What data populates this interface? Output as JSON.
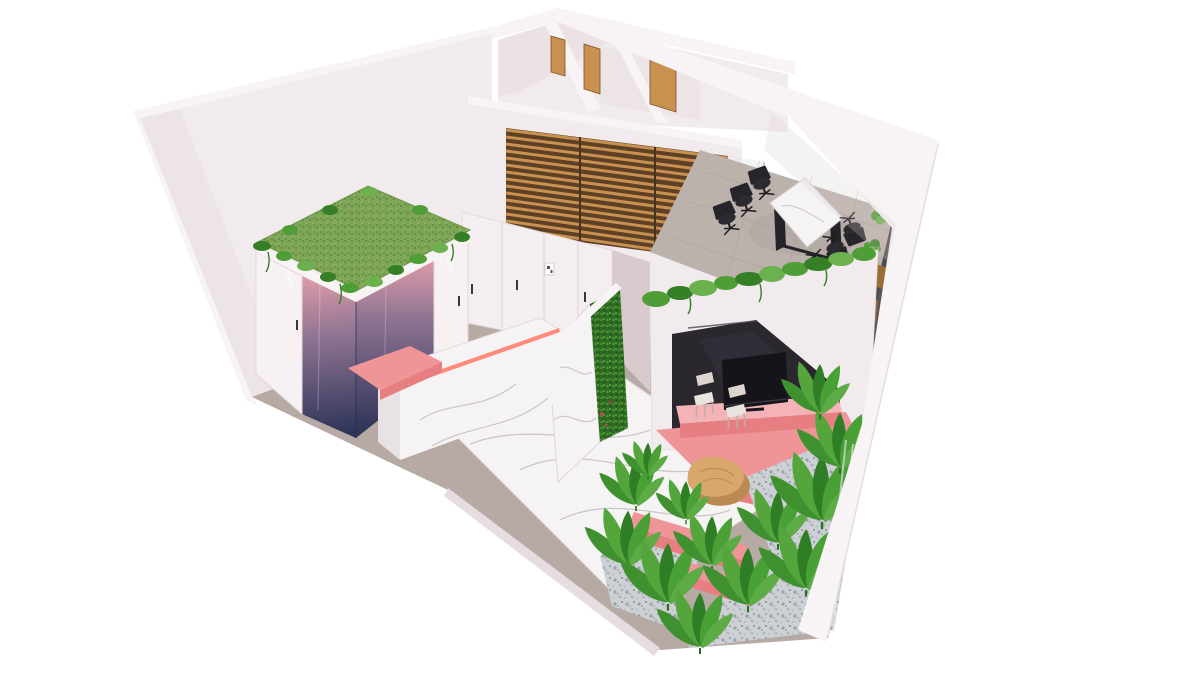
{
  "meta": {
    "title": "Isometric cutaway 3D render of a modern office interior",
    "canvas": {
      "width": 1200,
      "height": 675
    }
  },
  "palette": {
    "bg": "#ffffff",
    "wall": "#f2ebed",
    "wall-edge": "#f8f3f4",
    "wall-shade": "#e7dcdf",
    "wall-dark": "#d8cacd",
    "floor-tile": "#b7aaa4",
    "floor-tile-dark": "#a2968f",
    "marble": "#f6f3f4",
    "marble-vein": "#a9a3ad",
    "grass": "#7fa557",
    "grass-dark": "#5d8a3c",
    "leaf": "#4f9d36",
    "leaf-dark": "#357f26",
    "leaf-light": "#6bb14e",
    "booth-pink": "#f2a6ae",
    "booth-mid": "#8e7392",
    "booth-navy": "#2f3559",
    "coral": "#ef9598",
    "coral-dark": "#e67e82",
    "coral-bright": "#ff8b7c",
    "coral-light": "#f4b3b6",
    "wood": "#c8914f",
    "wood-dark": "#9a6c38",
    "slat-base": "#5d4026",
    "oak": "#d8a76c",
    "black": "#222127",
    "gloss-black": "#2a272e",
    "tv": "#15141a",
    "gravel": "#cdd1d5",
    "gravel-dot": "#9aa0a8",
    "glass": "#dfe9ec"
  },
  "booth": {
    "logo_text": "Glaze"
  },
  "scene": {
    "back_room_doors": 3,
    "meeting_chairs": 6,
    "nook_chairs": 2,
    "booth_pendant_discs": 3
  },
  "labels": {
    "scene": "Isometric cutaway 3D render of a modern office interior",
    "left_wall": "Left wall (cutaway)",
    "back_rooms": "Back rooms with wooden doors",
    "timber_screen": "Timber slat screen on mezzanine wall",
    "glass_partition": "Glass corner partition",
    "meeting_area": "Meeting area with tiled floor",
    "meeting_table": "Marble conference table",
    "office_chair": "Black office chair",
    "planters": "Wooden planters with greenery",
    "window_strip": "Dark window strip",
    "corridor_floor": "Corridor tile floor",
    "marble_walkway": "White marble walkway",
    "cabinets": "Built-in glossy white cabinets",
    "wall_sign": "Small wall sign",
    "reception_desk": "Marble reception desk with coral LED strip",
    "coral_shelf": "Coral ledge",
    "phone_booth": "Glass phone booth with grass roof",
    "grass_roof": "Grass roof with trailing plants",
    "booth_door": "Booth door with vertical logo",
    "pendant_discs": "Black pendant discs",
    "green_wall": "Marble partition with living green wall",
    "media_nook": "Pink media nook with gabled black wall",
    "tv": "Flat-screen TV",
    "nook_counter": "Pink media counter",
    "nook_chair": "Light chair",
    "hanging_plants": "Trailing plants on wall top",
    "lounge": "Lounge with marble floor",
    "coffee_table": "Organic wooden coffee table",
    "pink_bench": "Coral bench",
    "gravel": "White gravel bed",
    "plants": "Banana-leaf plants",
    "right_wall": "Right wall (cutaway)"
  }
}
